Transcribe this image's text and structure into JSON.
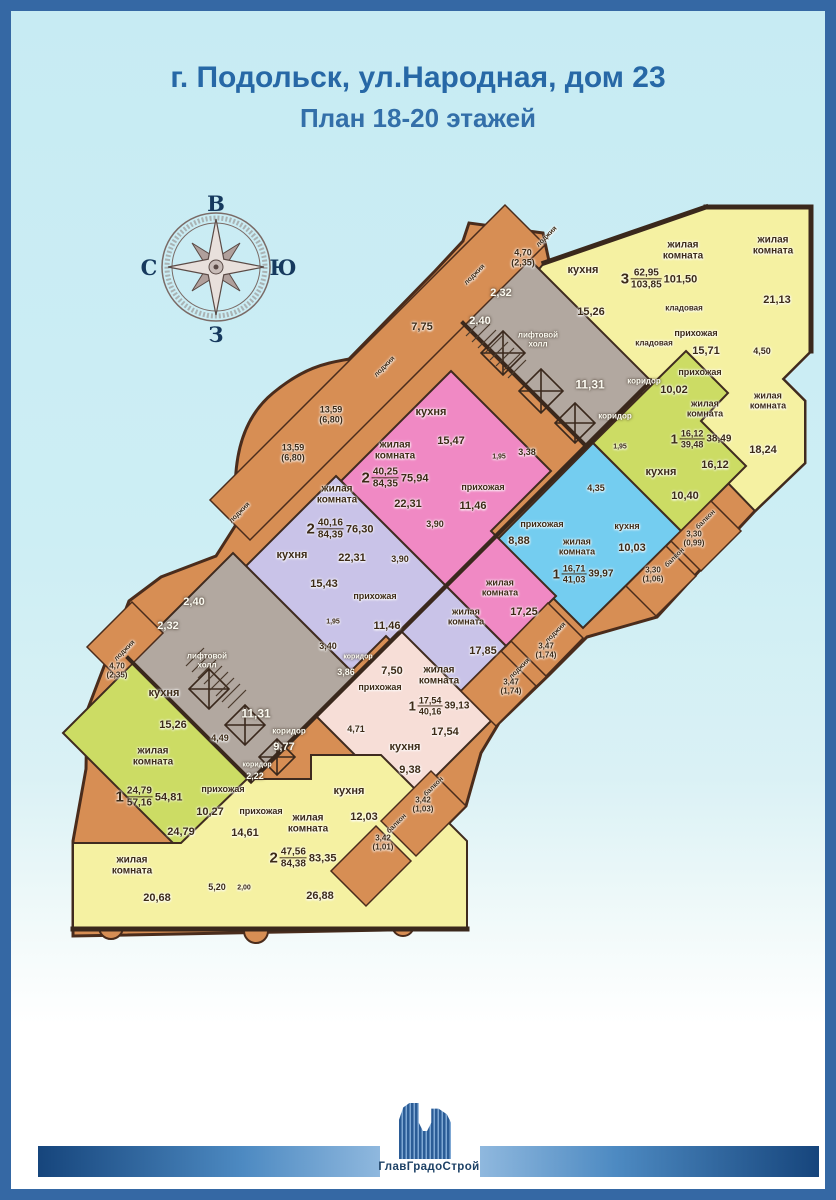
{
  "header": {
    "title": "г. Подольск, ул.Народная, дом 23",
    "subtitle": "План 18-20 этажей"
  },
  "compass": {
    "top": "В",
    "left": "С",
    "right": "Ю",
    "bottom": "З"
  },
  "apartments": {
    "top3": {
      "num": "3",
      "living": "62,95",
      "total": "103,85",
      "reduced": "101,50",
      "room1": "жилая комната",
      "room2": "жилая комната",
      "room2_area": "21,13",
      "room3": "жилая комната",
      "room3_area": "18,24",
      "kitchen": "кухня",
      "kitchen_area": "15,26",
      "storage1": "кладовая",
      "storage2": "кладовая",
      "hall": "прихожая",
      "hall_area": "15,71",
      "bath_area": "4,50"
    },
    "green_right": {
      "num": "1",
      "living": "16,12",
      "total": "39,48",
      "reduced": "38,49",
      "room": "жилая комната",
      "room_area": "16,12",
      "kitchen": "кухня",
      "kitchen_area": "10,40",
      "hall": "прихожая",
      "hall_area": "10,02",
      "bath_area": "1,95"
    },
    "blue": {
      "num": "1",
      "living": "16,71",
      "total": "41,03",
      "reduced": "39,97",
      "room": "жилая комната",
      "kitchen": "кухня",
      "kitchen_area": "10,03",
      "hall": "прихожая",
      "hall_area": "8,88",
      "bath_area": "4,35"
    },
    "pink": {
      "num": "2",
      "living": "40,25",
      "total": "84,35",
      "reduced": "75,94",
      "room1": "жилая комната",
      "room1_area": "22,31",
      "room2": "жилая комната",
      "room2_area": "17,25",
      "kitchen": "кухня",
      "kitchen_area": "15,47",
      "hall": "прихожая",
      "hall_area": "11,46",
      "wc_area": "1,95",
      "bath1_area": "3,38",
      "bath2_area": "3,90"
    },
    "lavender": {
      "num": "2",
      "living": "40,16",
      "total": "84,39",
      "reduced": "76,30",
      "room1": "жилая комната",
      "room1_area": "22,31",
      "room2": "жилая комната",
      "room2_area": "17,85",
      "kitchen": "кухня",
      "kitchen_area": "15,43",
      "hall": "прихожая",
      "hall_area": "11,46",
      "wc_area": "1,95",
      "bath1_area": "3,40",
      "bath2_area": "3,90"
    },
    "salmon": {
      "num": "1",
      "living": "17,54",
      "total": "40,16",
      "reduced": "39,13",
      "room": "жилая комната",
      "room_area": "17,54",
      "kitchen": "кухня",
      "kitchen_area": "9,38",
      "hall": "прихожая",
      "hall_area": "7,50",
      "bath_area": "4,71"
    },
    "green_left": {
      "num": "1",
      "living": "24,79",
      "total": "57,16",
      "reduced": "54,81",
      "room": "жилая комната",
      "room_area": "24,79",
      "kitchen": "кухня",
      "kitchen_area": "15,26",
      "hall": "прихожая",
      "hall_area": "10,27",
      "bath_area": "4,49"
    },
    "yellow_bottom": {
      "num": "2",
      "living": "47,56",
      "total": "84,38",
      "reduced": "83,35",
      "room1": "жилая комната",
      "room1_area": "20,68",
      "room2": "жилая комната",
      "room2_area": "26,88",
      "kitchen": "кухня",
      "kitchen_area": "12,03",
      "hall": "прихожая",
      "hall_area": "14,61",
      "bath_area": "5,20",
      "wc_area": "2,00"
    }
  },
  "common": {
    "upper": {
      "lift_hall": "лифтовой холл",
      "room1": "2,32",
      "room2": "2,40",
      "hall_area": "11,31",
      "corridor1": "коридор",
      "corridor2": "коридор"
    },
    "lower": {
      "lift_hall": "лифтовой холл",
      "room1": "2,32",
      "room2": "2,40",
      "hall_area": "11,31",
      "corridor1": "коридор",
      "corridor1_area": "9,77",
      "corridor2": "коридор",
      "corridor2_area": "2,22",
      "corridor3": "коридор",
      "corridor3_area": "3,86"
    }
  },
  "exterior": {
    "loggia_top": "лоджия",
    "loggia_top_area": "4,70 (2,35)",
    "loggia_left_small": "лоджия",
    "loggia_775_area": "7,75",
    "loggia_pink": "лоджия",
    "loggia_1359a_area": "13,59 (6,80)",
    "loggia_1359b_area": "13,59 (6,80)",
    "loggia_left2": "лоджия",
    "loggia_gl": "лоджия",
    "loggia_gl_area": "4,70 (2,35)",
    "balcony1": "балкон",
    "balcony1_area": "3,30 (0,99)",
    "balcony2": "балкон",
    "balcony2_area": "3,30 (1,06)",
    "loggia_b3": "лоджия",
    "loggia_b3_area": "3,47 (1,74)",
    "loggia_b4": "лоджия",
    "loggia_b4_area": "3,47 (1,74)",
    "balcony5": "балкон",
    "balcony5_area": "3,42 (1,03)",
    "balcony6": "балкон",
    "balcony6_area": "3,42 (1,01)"
  },
  "footer": {
    "company": "ГлавГрадоСтрой"
  }
}
